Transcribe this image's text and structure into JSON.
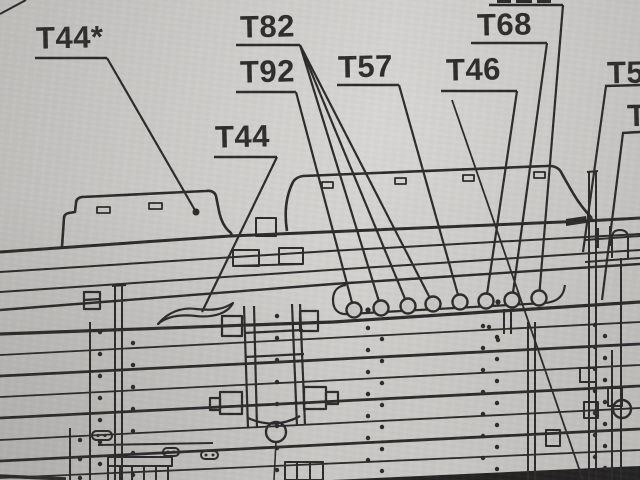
{
  "labels": {
    "t44_star": "T44*",
    "t82": "T82",
    "t92": "T92",
    "t44": "T44",
    "t57": "T57",
    "t46": "T46",
    "t68": "T68",
    "right_edge_top": "T5",
    "right_edge_mid": "T"
  },
  "colors": {
    "paper": "#c9c7c4",
    "ink": "#2b2b2b"
  },
  "counts": {
    "portholes": 8,
    "porthole_leader_lines": 8
  }
}
